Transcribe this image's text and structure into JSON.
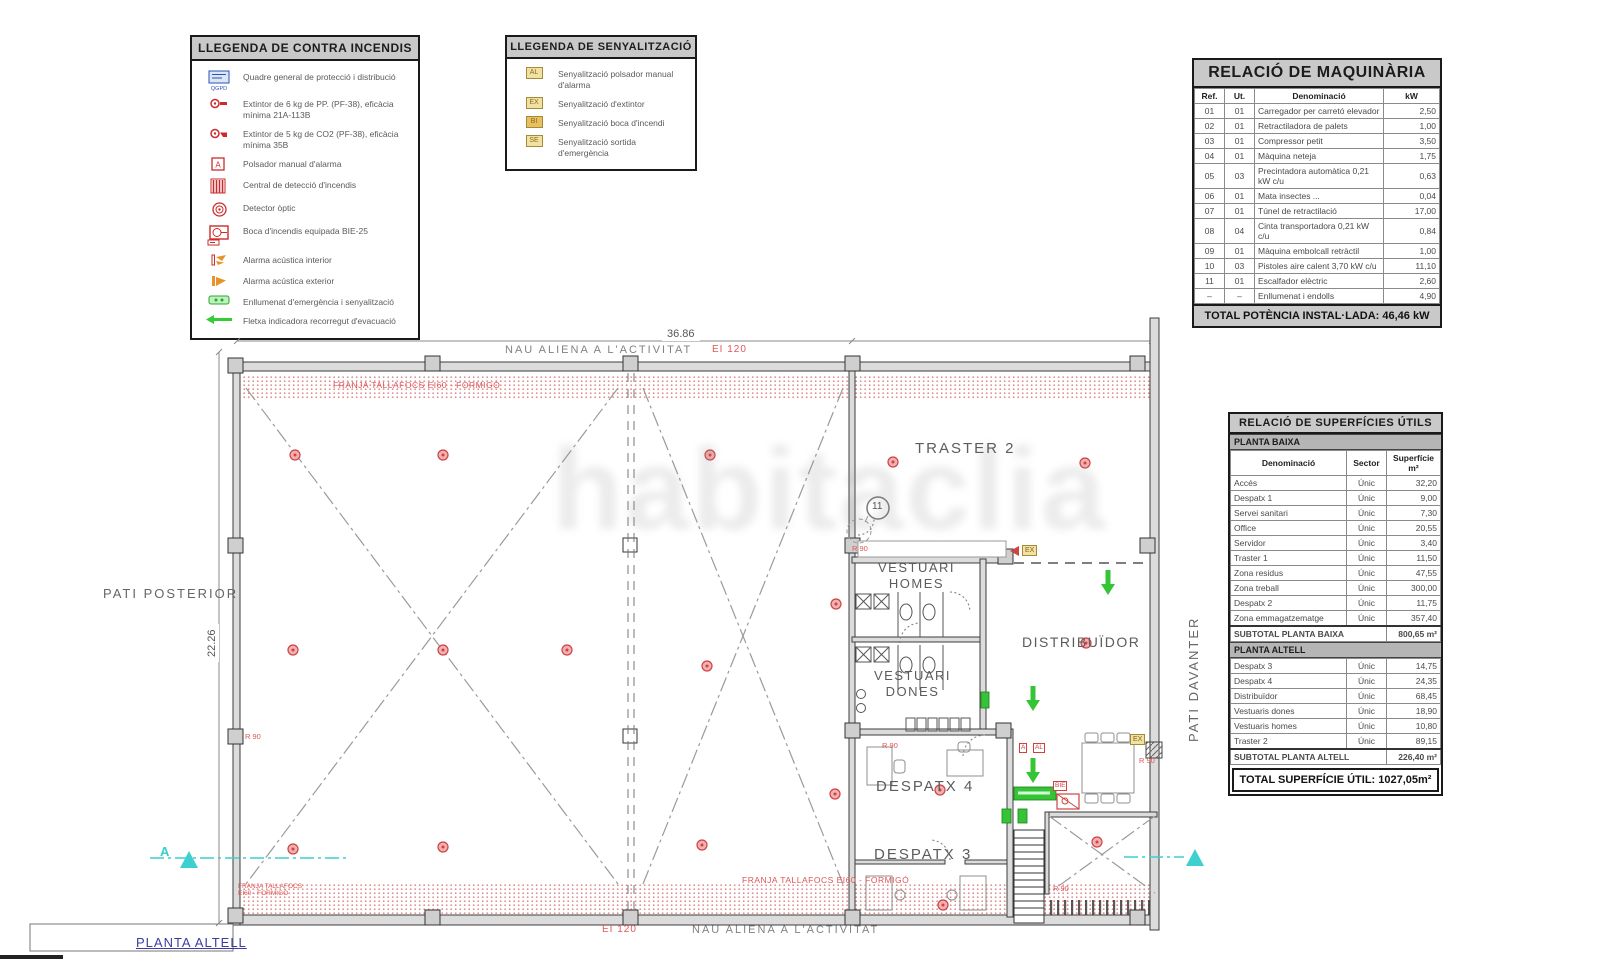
{
  "watermark": {
    "text": "habitaclia"
  },
  "legend_fire": {
    "title": "LLEGENDA DE CONTRA INCENDIS",
    "items": [
      {
        "icon": "qgpd-icon",
        "label": "Quadre general de protecció i distribució"
      },
      {
        "icon": "extinguisher-pp-icon",
        "label": "Extintor de 6 kg de PP. (PF-38), eficàcia mínima 21A-113B"
      },
      {
        "icon": "extinguisher-co2-icon",
        "label": "Extintor de 5 kg de CO2 (PF-38), eficàcia mínima 35B"
      },
      {
        "icon": "manual-alarm-icon",
        "label": "Polsador manual d'alarma"
      },
      {
        "icon": "fire-control-panel-icon",
        "label": "Central de detecció d'incendis"
      },
      {
        "icon": "optical-detector-icon",
        "label": "Detector òptic"
      },
      {
        "icon": "fire-hose-icon",
        "label": "Boca d'incendis equipada BIE-25"
      },
      {
        "icon": "interior-siren-icon",
        "label": "Alarma acústica interior"
      },
      {
        "icon": "exterior-siren-icon",
        "label": "Alarma acústica exterior"
      },
      {
        "icon": "emergency-light-icon",
        "label": "Enllumenat d'emergència i senyalització"
      },
      {
        "icon": "evacuation-arrow-icon",
        "label": "Fletxa indicadora recorregut d'evacuació"
      }
    ]
  },
  "legend_signage": {
    "title": "LLEGENDA DE SENYALITZACIÓ",
    "items": [
      {
        "icon": "AL",
        "label": "Senyalització polsador manual d'alarma"
      },
      {
        "icon": "EX",
        "label": "Senyalització d'extintor"
      },
      {
        "icon": "BI",
        "label": "Senyalització boca d'incendi"
      },
      {
        "icon": "SE",
        "label": "Senyalització sortida d'emergència"
      }
    ]
  },
  "machinery": {
    "title": "RELACIÓ DE MAQUINÀRIA",
    "columns": [
      "Ref.",
      "Ut.",
      "Denominació",
      "kW"
    ],
    "rows": [
      [
        "01",
        "01",
        "Carregador per carretó elevador",
        "2,50"
      ],
      [
        "02",
        "01",
        "Retractiladora de palets",
        "1,00"
      ],
      [
        "03",
        "01",
        "Compressor petit",
        "3,50"
      ],
      [
        "04",
        "01",
        "Màquina neteja",
        "1,75"
      ],
      [
        "05",
        "03",
        "Precintadora automàtica 0,21 kW c/u",
        "0,63"
      ],
      [
        "06",
        "01",
        "Mata insectes ...",
        "0,04"
      ],
      [
        "07",
        "01",
        "Túnel de retractilació",
        "17,00"
      ],
      [
        "08",
        "04",
        "Cinta transportadora 0,21 kW c/u",
        "0,84"
      ],
      [
        "09",
        "01",
        "Màquina embolcall retràctil",
        "1,00"
      ],
      [
        "10",
        "03",
        "Pistoles aire calent 3,70 kW c/u",
        "11,10"
      ],
      [
        "11",
        "01",
        "Escalfador elèctric",
        "2,60"
      ],
      [
        "–",
        "–",
        "Enllumenat i endolls",
        "4,90"
      ]
    ],
    "total": "TOTAL POTÈNCIA INSTAL·LADA: 46,46 kW"
  },
  "surfaces": {
    "title": "RELACIÓ DE SUPERFÍCIES ÚTILS",
    "columns": [
      "Denominació",
      "Sector",
      "Superfície m²"
    ],
    "baixa": {
      "section": "PLANTA BAIXA",
      "rows": [
        [
          "Accés",
          "Únic",
          "32,20"
        ],
        [
          "Despatx 1",
          "Únic",
          "9,00"
        ],
        [
          "Servei sanitari",
          "Únic",
          "7,30"
        ],
        [
          "Office",
          "Únic",
          "20,55"
        ],
        [
          "Servidor",
          "Únic",
          "3,40"
        ],
        [
          "Traster 1",
          "Únic",
          "11,50"
        ],
        [
          "Zona residus",
          "Únic",
          "47,55"
        ],
        [
          "Zona treball",
          "Únic",
          "300,00"
        ],
        [
          "Despatx 2",
          "Únic",
          "11,75"
        ],
        [
          "Zona emmagatzematge",
          "Únic",
          "357,40"
        ]
      ],
      "subtotal_label": "SUBTOTAL PLANTA BAIXA",
      "subtotal_value": "800,65 m²"
    },
    "altell": {
      "section": "PLANTA ALTELL",
      "rows": [
        [
          "Despatx 3",
          "Únic",
          "14,75"
        ],
        [
          "Despatx 4",
          "Únic",
          "24,35"
        ],
        [
          "Distribuïdor",
          "Únic",
          "68,45"
        ],
        [
          "Vestuaris dones",
          "Únic",
          "18,90"
        ],
        [
          "Vestuaris homes",
          "Únic",
          "10,80"
        ],
        [
          "Traster 2",
          "Únic",
          "89,15"
        ]
      ],
      "subtotal_label": "SUBTOTAL PLANTA ALTELL",
      "subtotal_value": "226,40 m²"
    },
    "total": "TOTAL SUPERFÍCIE ÚTIL: 1027,05m²"
  },
  "plan": {
    "labels": [
      {
        "name": "dim-width",
        "text": "36.86",
        "x": 662,
        "y": 328,
        "cls": "dim"
      },
      {
        "name": "dim-height",
        "text": "22.26",
        "x": 206,
        "y": 662,
        "cls": "dim rotl"
      },
      {
        "name": "nau-aliena-top",
        "text": "NAU ALIENA A L'ACTIVITAT",
        "x": 505,
        "y": 344,
        "cls": "zone"
      },
      {
        "name": "ei120-top",
        "text": "EI 120",
        "x": 712,
        "y": 344,
        "cls": "redlbl"
      },
      {
        "name": "franja-top",
        "text": "FRANJA TALLAFOCS EI60 - FORMIGÓ",
        "x": 333,
        "y": 380,
        "cls": "redlbl sm"
      },
      {
        "name": "pati-posterior",
        "text": "PATI POSTERIOR",
        "x": 103,
        "y": 586,
        "cls": "outlbl"
      },
      {
        "name": "pati-davanter",
        "text": "PATI DAVANTER",
        "x": 1186,
        "y": 742,
        "cls": "outlbl rotl"
      },
      {
        "name": "room-traster-2",
        "text": "TRASTER 2",
        "x": 915,
        "y": 440,
        "cls": "room"
      },
      {
        "name": "room-vestuari-homes",
        "text": "VESTUARI\nHOMES",
        "x": 878,
        "y": 560,
        "cls": "room sm ctr"
      },
      {
        "name": "room-vestuari-dones",
        "text": "VESTUARI\nDONES",
        "x": 874,
        "y": 668,
        "cls": "room sm ctr"
      },
      {
        "name": "room-distribuidor",
        "text": "DISTRIBUÏDOR",
        "x": 1022,
        "y": 634,
        "cls": "room sm2"
      },
      {
        "name": "room-despatx-4",
        "text": "DESPATX 4",
        "x": 876,
        "y": 778,
        "cls": "room"
      },
      {
        "name": "room-despatx-3",
        "text": "DESPATX 3",
        "x": 874,
        "y": 846,
        "cls": "room"
      },
      {
        "name": "machine-ref-11",
        "text": "11",
        "x": 872,
        "y": 501,
        "cls": "mref"
      },
      {
        "name": "r90-left",
        "text": "R 90",
        "x": 245,
        "y": 732,
        "cls": "redlbl xs"
      },
      {
        "name": "r90-traster",
        "text": "R 90",
        "x": 852,
        "y": 544,
        "cls": "redlbl xs"
      },
      {
        "name": "r90-despatx4",
        "text": "R 90",
        "x": 882,
        "y": 741,
        "cls": "redlbl xs"
      },
      {
        "name": "r90-right",
        "text": "R 90",
        "x": 1139,
        "y": 756,
        "cls": "redlbl xs"
      },
      {
        "name": "r90-bottom-right",
        "text": "R 90",
        "x": 1053,
        "y": 884,
        "cls": "redlbl xs"
      },
      {
        "name": "ex-sign-traster",
        "text": "EX",
        "x": 1022,
        "y": 545,
        "cls": "sign-yellow"
      },
      {
        "name": "ex-sign-right",
        "text": "EX",
        "x": 1130,
        "y": 734,
        "cls": "sign-yellow"
      },
      {
        "name": "alarm-sign-a",
        "text": "A",
        "x": 1019,
        "y": 743,
        "cls": "sign-red"
      },
      {
        "name": "alarm-sign-al",
        "text": "AL",
        "x": 1033,
        "y": 743,
        "cls": "sign-red"
      },
      {
        "name": "bie-sign",
        "text": "BIE",
        "x": 1053,
        "y": 781,
        "cls": "sign-red"
      },
      {
        "name": "franja-bottom",
        "text": "FRANJA TALLAFOCS EI60 - FORMIGÓ",
        "x": 742,
        "y": 875,
        "cls": "redlbl sm"
      },
      {
        "name": "franja-bottom-left",
        "text": "FRANJA TALLAFOCS\nEI60 - FORMIGÓ",
        "x": 238,
        "y": 883,
        "cls": "redlbl xxs"
      },
      {
        "name": "nau-aliena-bottom",
        "text": "NAU ALIENA A L'ACTIVITAT",
        "x": 692,
        "y": 924,
        "cls": "zone"
      },
      {
        "name": "ei120-bottom",
        "text": "EI 120",
        "x": 602,
        "y": 924,
        "cls": "redlbl"
      },
      {
        "name": "planta-altell-label",
        "text": "PLANTA ALTELL",
        "x": 136,
        "y": 935,
        "cls": "bluelbl"
      },
      {
        "name": "section-a-letter",
        "text": "A",
        "x": 160,
        "y": 844,
        "cls": "cyanlbl"
      }
    ]
  }
}
